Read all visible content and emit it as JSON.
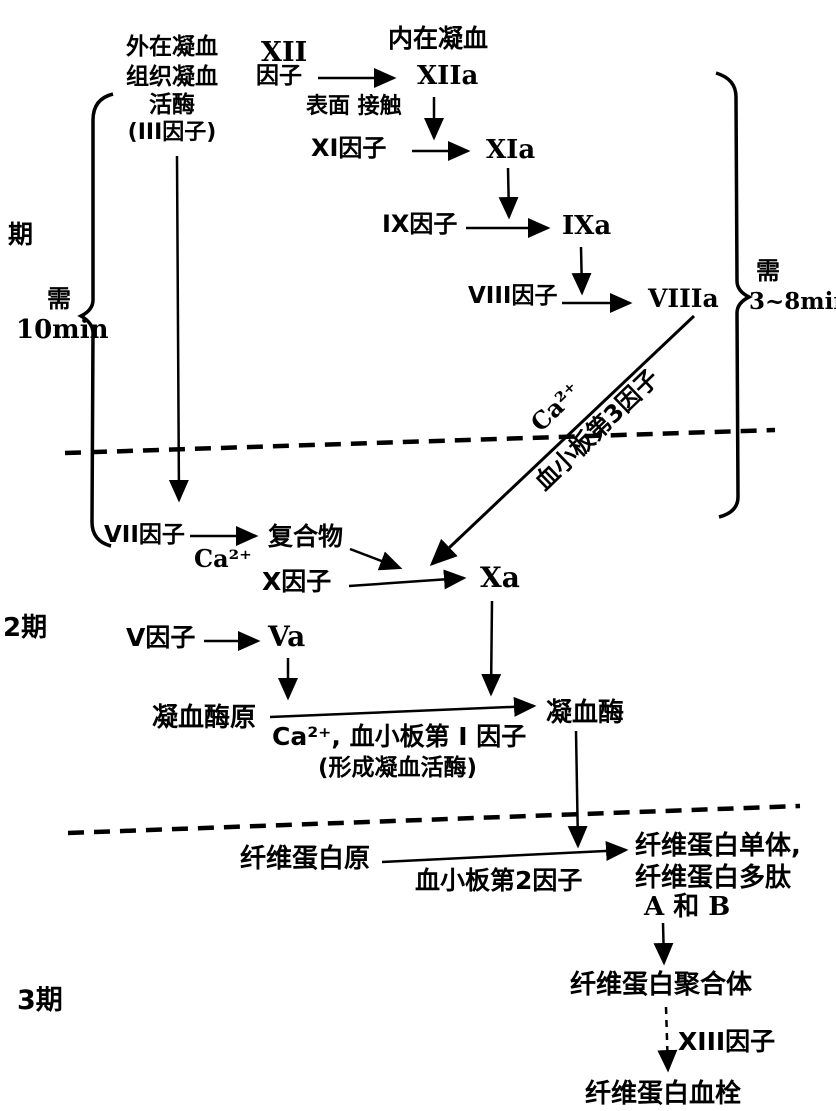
{
  "diagram": {
    "stage_labels": {
      "stage1": "期",
      "stage2": "2期",
      "stage3": "3期"
    },
    "timing": {
      "left_need": "需",
      "left_time": "10min",
      "right_need": "需",
      "right_time": "3~8min"
    },
    "extrinsic_header": [
      "外在凝血",
      "组织凝血",
      "活酶",
      "(III因子)"
    ],
    "intrinsic_header": "内在凝血",
    "nodes": {
      "xii_line1": "XII",
      "xii_line2": "因子",
      "xiia": "XIIa",
      "surface_contact": "表面 接触",
      "xi_factor": "XI因子",
      "xia": "XIa",
      "ix_factor": "IX因子",
      "ixa": "IXa",
      "viii_factor": "VIII因子",
      "viiia": "VIIIa",
      "ca_diagonal": "Ca²⁺",
      "platelet3_diagonal": "血小板第3因子",
      "vii_factor": "VII因子",
      "ca_vii": "Ca²⁺",
      "complex": "复合物",
      "x_factor": "X因子",
      "xa": "Xa",
      "v_factor": "V因子",
      "va": "Va",
      "prothrombin": "凝血酶原",
      "thrombin": "凝血酶",
      "ca_platelet1": "Ca²⁺, 血小板第 I 因子",
      "forming_note": "(形成凝血活酶)",
      "fibrinogen": "纤维蛋白原",
      "platelet2": "血小板第2因子",
      "fibrin_monomer_l1": "纤维蛋白单体,",
      "fibrin_monomer_l2": "纤维蛋白多肽",
      "fibrin_monomer_l3": "A 和 B",
      "fibrin_polymer": "纤维蛋白聚合体",
      "xiii_factor": "XIII因子",
      "fibrin_clot": "纤维蛋白血栓"
    },
    "colors": {
      "ink": "#000000",
      "paper": "#ffffff"
    }
  }
}
